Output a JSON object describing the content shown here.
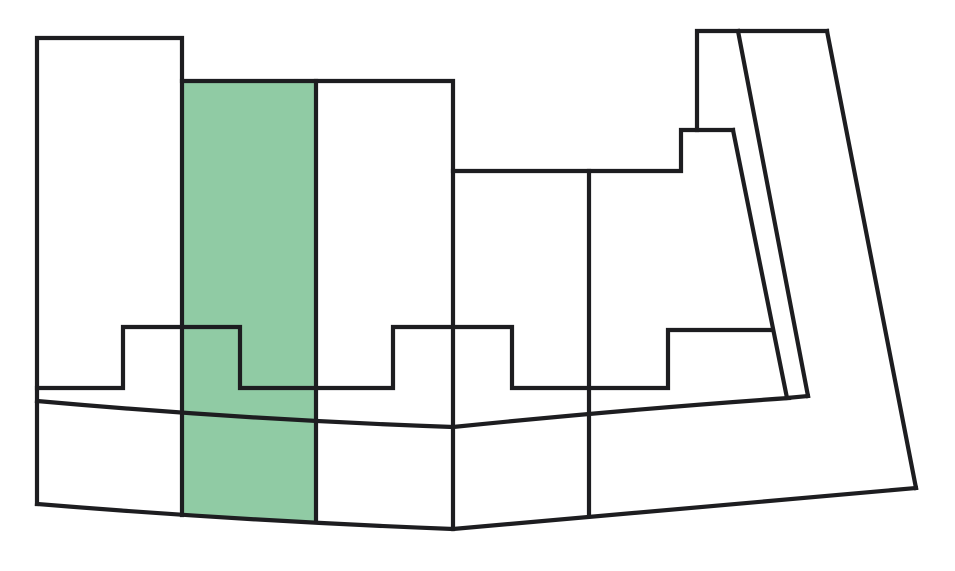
{
  "canvas": {
    "width": 955,
    "height": 571,
    "background": "#ffffff"
  },
  "diagram": {
    "type": "parcel-outline-map",
    "description": "Black-outlined parcel map with one highlighted parcel strip",
    "stroke": {
      "color": "#1d1d20",
      "width": 4.2
    },
    "highlight_color": "#90CBA4",
    "highlighted_parcel": {
      "id": "highlighted-parcel",
      "fill": "#90CBA4",
      "path": "M 182,81 L 316,81 L 316,521 Q 250,519 182,515 Z"
    },
    "outlines": [
      {
        "id": "left-parcel-outline",
        "path": "M 37,504 L 37,38 L 182,38 L 182,515"
      },
      {
        "id": "strips-top-edge",
        "path": "M 182,81 L 453,81 L 453,529"
      },
      {
        "id": "highlight-right-edge",
        "path": "M 316,81 L 316,521"
      },
      {
        "id": "middle-band-top-step",
        "path": "M 453,171 L 681,171 L 681,130 L 733,130"
      },
      {
        "id": "top-right-parcel-edge",
        "path": "M 697,130 L 697,31 L 827,31"
      },
      {
        "id": "inner-slant-left",
        "path": "M 733,130 L 787,398 L 808,396"
      },
      {
        "id": "inner-slant-right",
        "path": "M 738,31 L 808,396"
      },
      {
        "id": "outer-slant-edge",
        "path": "M 827,31 L 916,488"
      },
      {
        "id": "center-divider",
        "path": "M 589,171 L 589,515"
      },
      {
        "id": "notched-boundary",
        "path": "M 37,388 L 123,388 L 123,327 L 240,327 L 240,388 L 393,388 L 393,327 L 512,327 L 512,388 L 668,388 L 668,330 L 772,330"
      },
      {
        "id": "upper-road-line",
        "path": "M 37,401 Q 250,420 453,427 Q 630,409 789,398"
      },
      {
        "id": "lower-road-line",
        "path": "M 37,504 Q 245,521 453,529 L 916,488"
      }
    ]
  }
}
